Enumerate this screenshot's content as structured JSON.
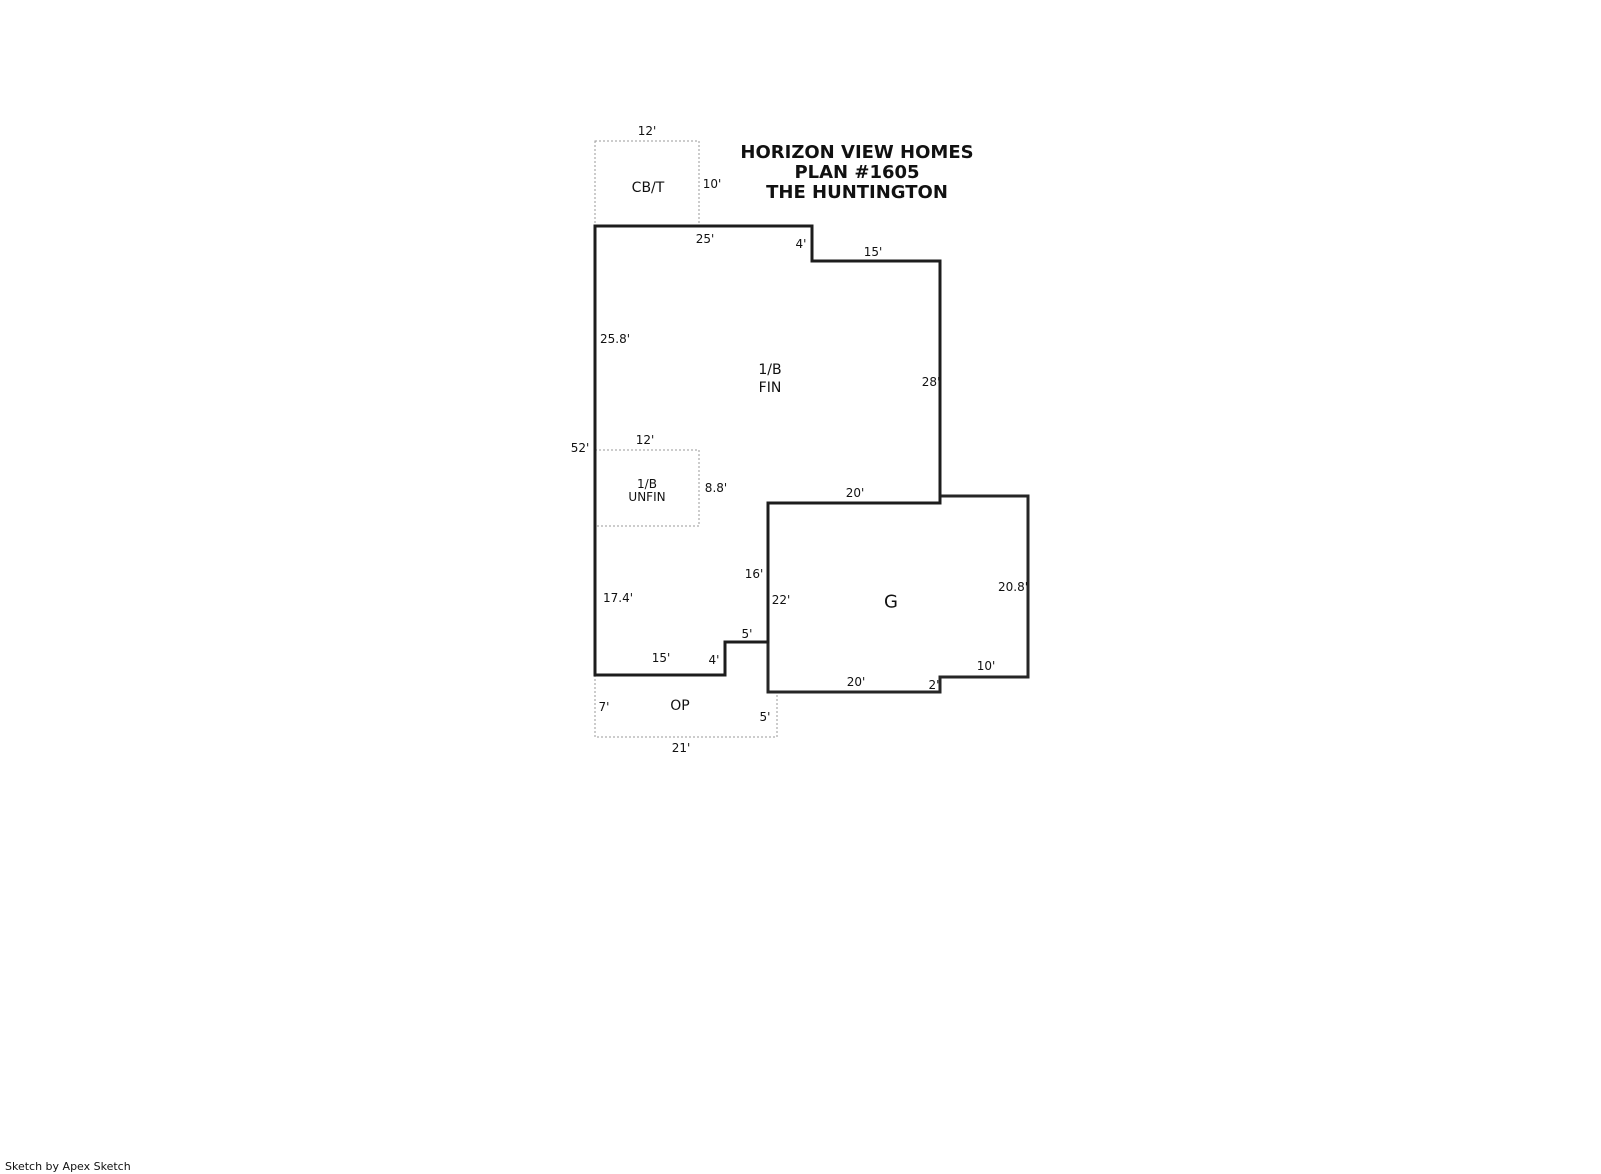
{
  "title": {
    "line1": "HORIZON VIEW HOMES",
    "line2": "PLAN #1605",
    "line3": "THE HUNTINGTON"
  },
  "rooms": {
    "cbt": "CB/T",
    "fin_line1": "1/B",
    "fin_line2": "FIN",
    "unfin_line1": "1/B",
    "unfin_line2": "UNFIN",
    "garage": "G",
    "op": "OP"
  },
  "dimensions": {
    "cbt_width": "12'",
    "cbt_height": "10'",
    "main_top": "25'",
    "main_top_step": "4'",
    "main_top_right": "15'",
    "left_upper": "25.8'",
    "left_total": "52'",
    "left_lower": "17.4'",
    "right_upper": "28'",
    "unfin_width": "12'",
    "unfin_height": "8.8'",
    "garage_top": "20'",
    "interior_step": "16'",
    "garage_left": "22'",
    "garage_right": "20.8'",
    "notch_step": "5'",
    "bottom_left": "15'",
    "bottom_step": "4'",
    "garage_bottom": "20'",
    "garage_bottom_step": "2'",
    "garage_bottom_right": "10'",
    "op_left": "7'",
    "op_right": "5'",
    "op_bottom": "21'"
  },
  "footer": {
    "credit": "Sketch by Apex Sketch"
  },
  "colors": {
    "wall": "#1d1d1d",
    "dotted_outline": "#9a9a9a",
    "text": "#111111",
    "background": "#ffffff"
  },
  "floorplan": {
    "main_outline": "595,226 812,226 812,261 940,261 940,503 768,503 768,642 725,642 725,675 595,675",
    "garage_outline": "768,503 940,503 940,496 1028,496 1028,677 940,677 940,692 768,692",
    "cbt_box": "595,141 699,141 699,226 595,226",
    "unfin_box": "595,450 699,450 699,526 595,526",
    "op_outline": "595,675 595,737 777,737 777,692"
  }
}
